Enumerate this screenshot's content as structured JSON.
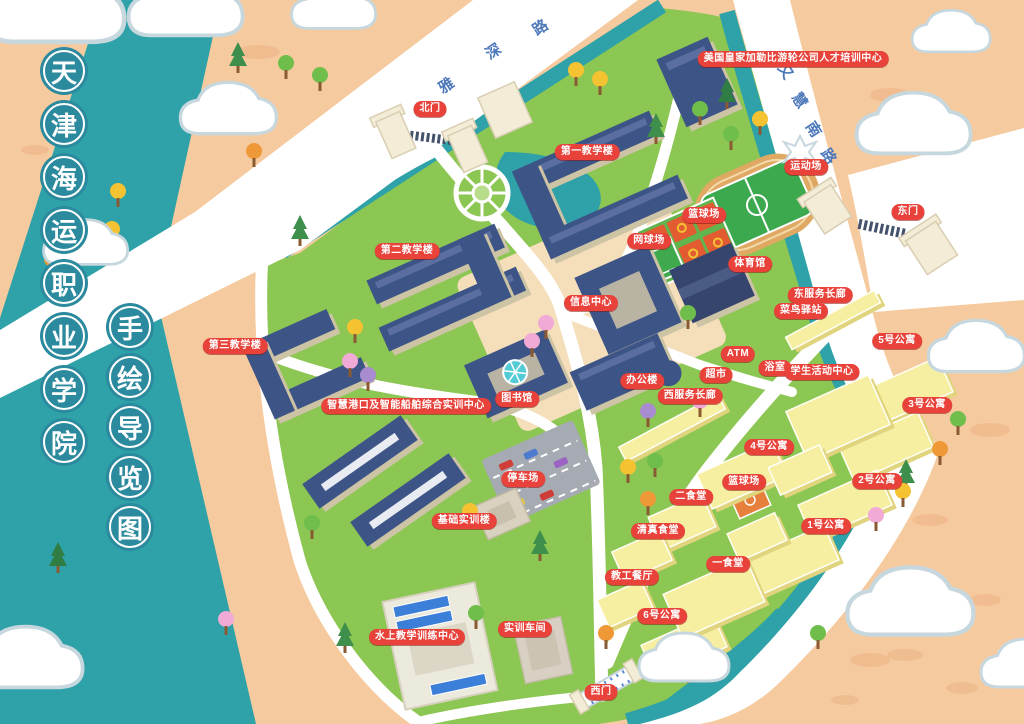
{
  "map_title": {
    "college_name": "天津海运职业学院",
    "college_chars": [
      "天",
      "津",
      "海",
      "运",
      "职",
      "业",
      "学",
      "院"
    ],
    "subtitle_name": "手绘导览图",
    "subtitle_chars": [
      "手",
      "绘",
      "导",
      "览",
      "图"
    ]
  },
  "roads": [
    {
      "name": "雅深路",
      "rotation": -33,
      "chars": [
        {
          "ch": "雅",
          "x": 446,
          "y": 85
        },
        {
          "ch": "深",
          "x": 493,
          "y": 51
        },
        {
          "ch": "路",
          "x": 540,
          "y": 27
        }
      ]
    },
    {
      "name": "又慧南路",
      "rotation": 57,
      "chars": [
        {
          "ch": "又",
          "x": 786,
          "y": 71
        },
        {
          "ch": "慧",
          "x": 800,
          "y": 100
        },
        {
          "ch": "南",
          "x": 814,
          "y": 129
        },
        {
          "ch": "路",
          "x": 829,
          "y": 156
        }
      ]
    }
  ],
  "labels": [
    {
      "id": "royal-caribbean-center",
      "text": "美国皇家加勒比游轮公司人才培训中心",
      "x": 793,
      "y": 59
    },
    {
      "id": "north-gate",
      "text": "北门",
      "x": 430,
      "y": 109
    },
    {
      "id": "teaching-building-1",
      "text": "第一教学楼",
      "x": 587,
      "y": 152
    },
    {
      "id": "stadium",
      "text": "运动场",
      "x": 806,
      "y": 167
    },
    {
      "id": "east-gate",
      "text": "东门",
      "x": 908,
      "y": 212
    },
    {
      "id": "basketball-court-north",
      "text": "篮球场",
      "x": 704,
      "y": 215
    },
    {
      "id": "tennis-court",
      "text": "网球场",
      "x": 649,
      "y": 241
    },
    {
      "id": "teaching-building-2",
      "text": "第二教学楼",
      "x": 407,
      "y": 251
    },
    {
      "id": "gymnasium",
      "text": "体育馆",
      "x": 750,
      "y": 264
    },
    {
      "id": "east-service-corridor",
      "text": "东服务长廊",
      "x": 820,
      "y": 295
    },
    {
      "id": "info-center",
      "text": "信息中心",
      "x": 591,
      "y": 303
    },
    {
      "id": "cainiao-station",
      "text": "菜鸟驿站",
      "x": 801,
      "y": 311
    },
    {
      "id": "dorm-5",
      "text": "5号公寓",
      "x": 897,
      "y": 341
    },
    {
      "id": "teaching-building-3",
      "text": "第三教学楼",
      "x": 235,
      "y": 346
    },
    {
      "id": "atm",
      "text": "ATM",
      "x": 738,
      "y": 354
    },
    {
      "id": "bathhouse",
      "text": "浴室",
      "x": 775,
      "y": 368
    },
    {
      "id": "student-activity-center",
      "text": "学生活动中心",
      "x": 822,
      "y": 372
    },
    {
      "id": "supermarket",
      "text": "超市",
      "x": 716,
      "y": 375
    },
    {
      "id": "office-building",
      "text": "办公楼",
      "x": 642,
      "y": 381
    },
    {
      "id": "west-service-corridor",
      "text": "西服务长廊",
      "x": 690,
      "y": 396
    },
    {
      "id": "library",
      "text": "图书馆",
      "x": 517,
      "y": 399
    },
    {
      "id": "smart-port-training-center",
      "text": "智慧港口及智能船舶综合实训中心",
      "x": 406,
      "y": 406
    },
    {
      "id": "dorm-3",
      "text": "3号公寓",
      "x": 927,
      "y": 405
    },
    {
      "id": "dorm-4",
      "text": "4号公寓",
      "x": 769,
      "y": 447
    },
    {
      "id": "parking-lot",
      "text": "停车场",
      "x": 523,
      "y": 479
    },
    {
      "id": "basketball-court-south",
      "text": "篮球场",
      "x": 744,
      "y": 482
    },
    {
      "id": "dorm-2",
      "text": "2号公寓",
      "x": 877,
      "y": 481
    },
    {
      "id": "canteen-2",
      "text": "二食堂",
      "x": 691,
      "y": 497
    },
    {
      "id": "basic-training-building",
      "text": "基础实训楼",
      "x": 464,
      "y": 521
    },
    {
      "id": "dorm-1",
      "text": "1号公寓",
      "x": 826,
      "y": 526
    },
    {
      "id": "halal-canteen",
      "text": "清真食堂",
      "x": 658,
      "y": 531
    },
    {
      "id": "canteen-1",
      "text": "一食堂",
      "x": 728,
      "y": 564
    },
    {
      "id": "staff-canteen",
      "text": "教工餐厅",
      "x": 632,
      "y": 577
    },
    {
      "id": "dorm-6",
      "text": "6号公寓",
      "x": 662,
      "y": 616
    },
    {
      "id": "water-training-center",
      "text": "水上教学训练中心",
      "x": 417,
      "y": 637
    },
    {
      "id": "workshop",
      "text": "实训车间",
      "x": 525,
      "y": 629
    },
    {
      "id": "west-gate",
      "text": "西门",
      "x": 601,
      "y": 692
    }
  ],
  "colors": {
    "background_peach": "#F6CA9F",
    "water_teal": "#2EA2A8",
    "grass_green": "#8CC653",
    "road_white": "#FFFFFF",
    "roof_blue": "#3D5486",
    "apartment_yellow": "#F6EFA2",
    "label_red": "#E8423B",
    "title_circle_teal": "#2B8A9D",
    "road_text_blue": "#4D79BB"
  }
}
